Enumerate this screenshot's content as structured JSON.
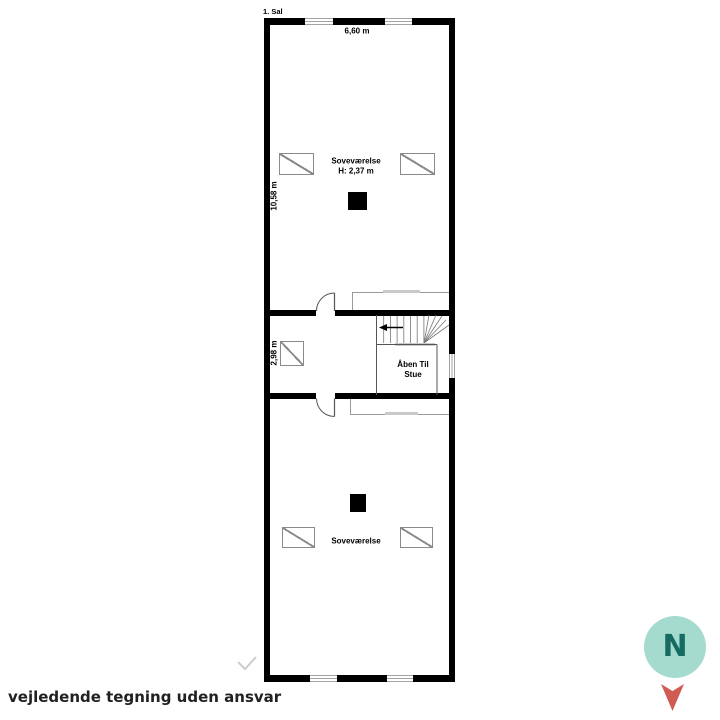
{
  "plan": {
    "floor_label": "1. Sal",
    "top_dimension": "6,60 m",
    "upper_bedroom": {
      "name": "Soveværelse",
      "ceiling_height": "H: 2,37 m",
      "length_dimension": "10,58 m"
    },
    "hall": {
      "width_dimension": "2,98 m"
    },
    "stair_void": {
      "line1": "Åben Til",
      "line2": "Stue"
    },
    "lower_bedroom": {
      "name": "Soveværelse"
    }
  },
  "footer": {
    "disclaimer": "vejledende tegning uden ansvar"
  },
  "compass": {
    "label": "N",
    "circle_color": "#a5dbce",
    "letter_color": "#156a61",
    "arrow_color": "#d05b52"
  },
  "colors": {
    "wall": "#000000",
    "thin_line": "#555555",
    "light_line": "#8a8a8a",
    "rail_cap": "#c9c9c9"
  }
}
